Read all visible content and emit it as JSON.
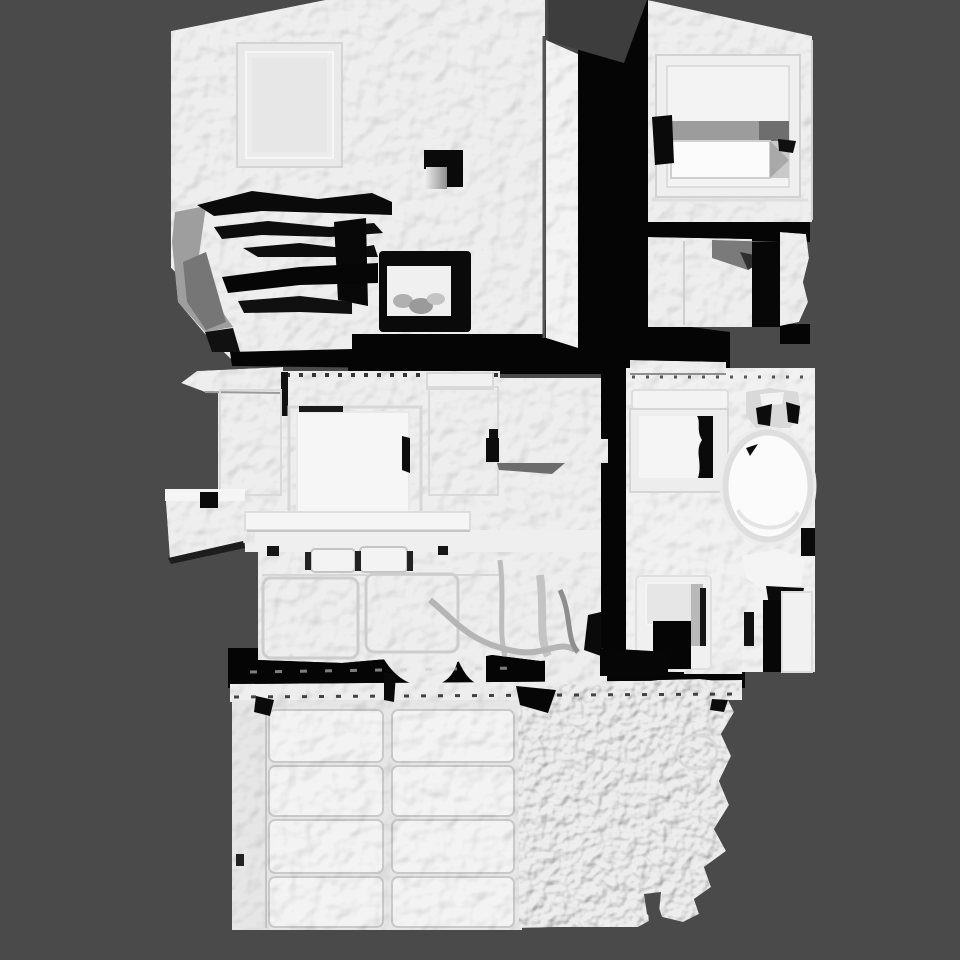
{
  "scene": {
    "description": "Shaded 3D scan mesh of a multi-room building viewed from above (dollhouse view)",
    "colors": {
      "background": "#4a4a4a",
      "mesh": "#eeeeee",
      "mesh_bright": "#f6f6f6",
      "panel": "#f3f3f3",
      "door_slab": "#e6e6e6",
      "shadow": "#050505",
      "roof_shade": "#3d3d3d",
      "rough_mesh": "#ededed",
      "rim_gray": "#dedede"
    },
    "structures": [
      {
        "id": "upper-left-room",
        "label": "upper room with wall opening and debris pile"
      },
      {
        "id": "upper-right-room",
        "label": "upper room with recessed window and white box"
      },
      {
        "id": "center-wall",
        "label": "vertical wall slab with shaded roof wedge"
      },
      {
        "id": "middle-left-room",
        "label": "kitchen room with bright square panel, counter and cabinets"
      },
      {
        "id": "bathroom",
        "label": "room with oval tub, shower inset and doorway"
      },
      {
        "id": "garage",
        "label": "garage with paneled door"
      },
      {
        "id": "rough-wall",
        "label": "rough scanned wall surface"
      }
    ],
    "garage_door": {
      "rows": 4,
      "columns": 2
    }
  }
}
